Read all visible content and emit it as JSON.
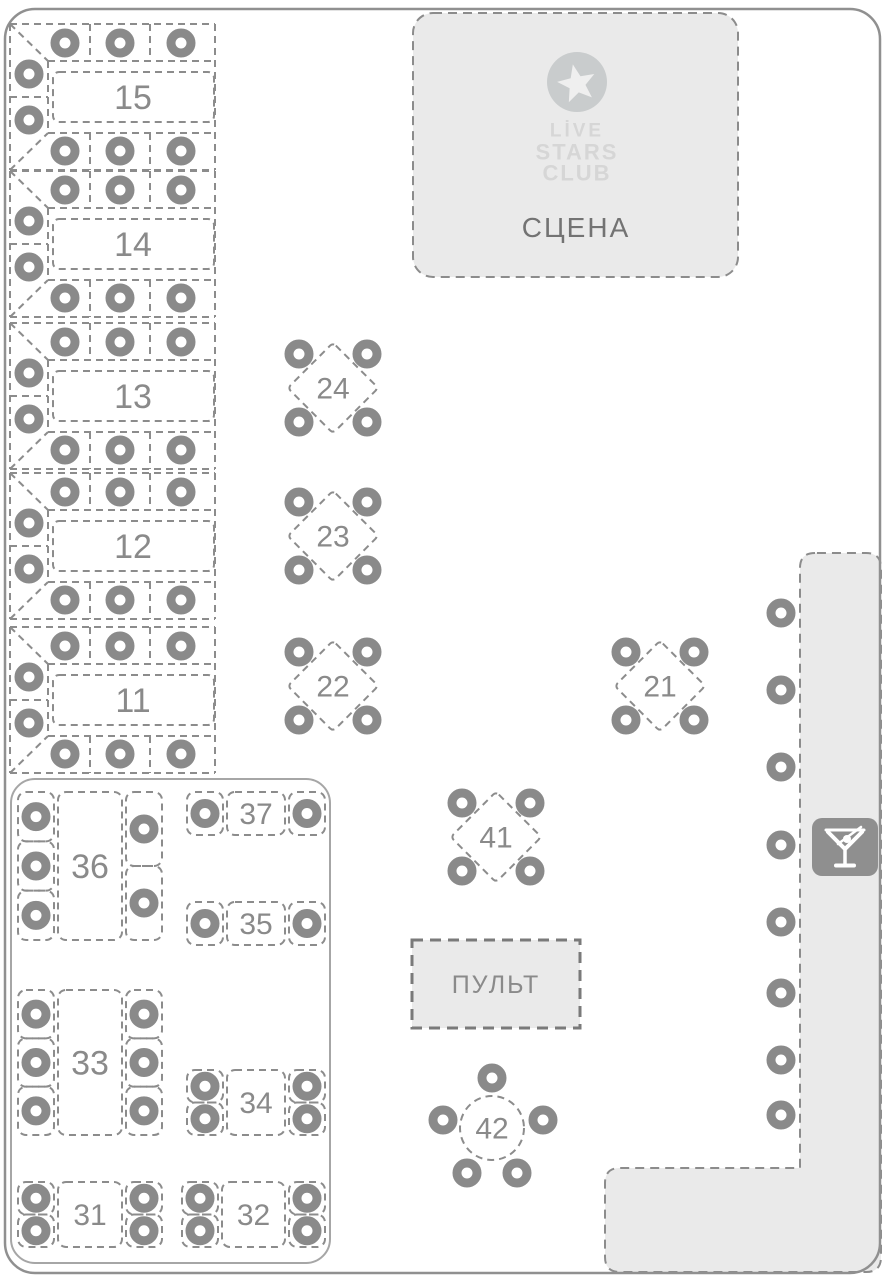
{
  "canvas": {
    "width": 884,
    "height": 1280,
    "background": "#ffffff"
  },
  "colors": {
    "line": "#8c8c8c",
    "chair": "#8a8a8a",
    "number": "#8a8a8a",
    "area_fill": "#eaeaea",
    "floor_border": "#909090",
    "section_border": "#a6a6a6",
    "stage_text": "#737373",
    "logo_text": "#d6d6d6",
    "logo_circle": "#c9cccd",
    "logo_star": "#efefef",
    "icon_box": "#8f8f8f",
    "pult_border": "#7a7a7a"
  },
  "stage": {
    "label": "СЦЕНА",
    "logo": {
      "lines": [
        "LİVE",
        "STARS",
        "CLUB"
      ],
      "icon": "star-icon"
    },
    "x": 413,
    "y": 13,
    "w": 325,
    "h": 264
  },
  "console": {
    "label": "ПУЛЬТ",
    "x": 412,
    "y": 940,
    "w": 168,
    "h": 88
  },
  "bar": {
    "icon": "martini-glass-icon",
    "chair_x": 781,
    "chairs_y": [
      613,
      690,
      767,
      845,
      922,
      993,
      1060,
      1115
    ],
    "seats": 8
  },
  "vip_section": {
    "x": 11,
    "y": 779,
    "w": 319,
    "h": 484
  },
  "tables": [
    {
      "id": "15",
      "label": "15",
      "type": "banquet",
      "cy": 97,
      "seats": 8
    },
    {
      "id": "14",
      "label": "14",
      "type": "banquet",
      "cy": 244,
      "seats": 8
    },
    {
      "id": "13",
      "label": "13",
      "type": "banquet",
      "cy": 396,
      "seats": 8
    },
    {
      "id": "12",
      "label": "12",
      "type": "banquet",
      "cy": 546,
      "seats": 8
    },
    {
      "id": "11",
      "label": "11",
      "type": "banquet",
      "cy": 700,
      "seats": 8
    },
    {
      "id": "24",
      "label": "24",
      "type": "diamond",
      "cx": 333,
      "cy": 388,
      "seats": 4
    },
    {
      "id": "23",
      "label": "23",
      "type": "diamond",
      "cx": 333,
      "cy": 536,
      "seats": 4
    },
    {
      "id": "22",
      "label": "22",
      "type": "diamond",
      "cx": 333,
      "cy": 686,
      "seats": 4
    },
    {
      "id": "21",
      "label": "21",
      "type": "diamond",
      "cx": 660,
      "cy": 686,
      "seats": 4
    },
    {
      "id": "41",
      "label": "41",
      "type": "diamond",
      "cx": 496,
      "cy": 837,
      "seats": 4
    },
    {
      "id": "42",
      "label": "42",
      "type": "round",
      "cx": 492,
      "cy": 1128,
      "seats": 5
    },
    {
      "id": "36",
      "label": "36",
      "type": "rect-v",
      "x": 58,
      "y": 792,
      "w": 64,
      "h": 148,
      "left_chairs": 3,
      "right_chairs": 2,
      "seats": 5
    },
    {
      "id": "37",
      "label": "37",
      "type": "rect-h",
      "x": 227,
      "y": 792,
      "w": 58,
      "h": 43,
      "left_chairs": 1,
      "right_chairs": 1,
      "seats": 2
    },
    {
      "id": "35",
      "label": "35",
      "type": "rect-h",
      "x": 227,
      "y": 902,
      "w": 58,
      "h": 43,
      "left_chairs": 1,
      "right_chairs": 1,
      "seats": 2
    },
    {
      "id": "33",
      "label": "33",
      "type": "rect-v",
      "x": 58,
      "y": 990,
      "w": 64,
      "h": 145,
      "left_chairs": 3,
      "right_chairs": 3,
      "seats": 6
    },
    {
      "id": "34",
      "label": "34",
      "type": "rect-h",
      "x": 227,
      "y": 1070,
      "w": 58,
      "h": 65,
      "left_chairs": 2,
      "right_chairs": 2,
      "seats": 4
    },
    {
      "id": "31",
      "label": "31",
      "type": "rect-h",
      "x": 58,
      "y": 1182,
      "w": 64,
      "h": 65,
      "left_chairs": 2,
      "right_chairs": 2,
      "seats": 4
    },
    {
      "id": "32",
      "label": "32",
      "type": "rect-h",
      "x": 222,
      "y": 1182,
      "w": 63,
      "h": 65,
      "left_chairs": 2,
      "right_chairs": 2,
      "seats": 4
    }
  ]
}
